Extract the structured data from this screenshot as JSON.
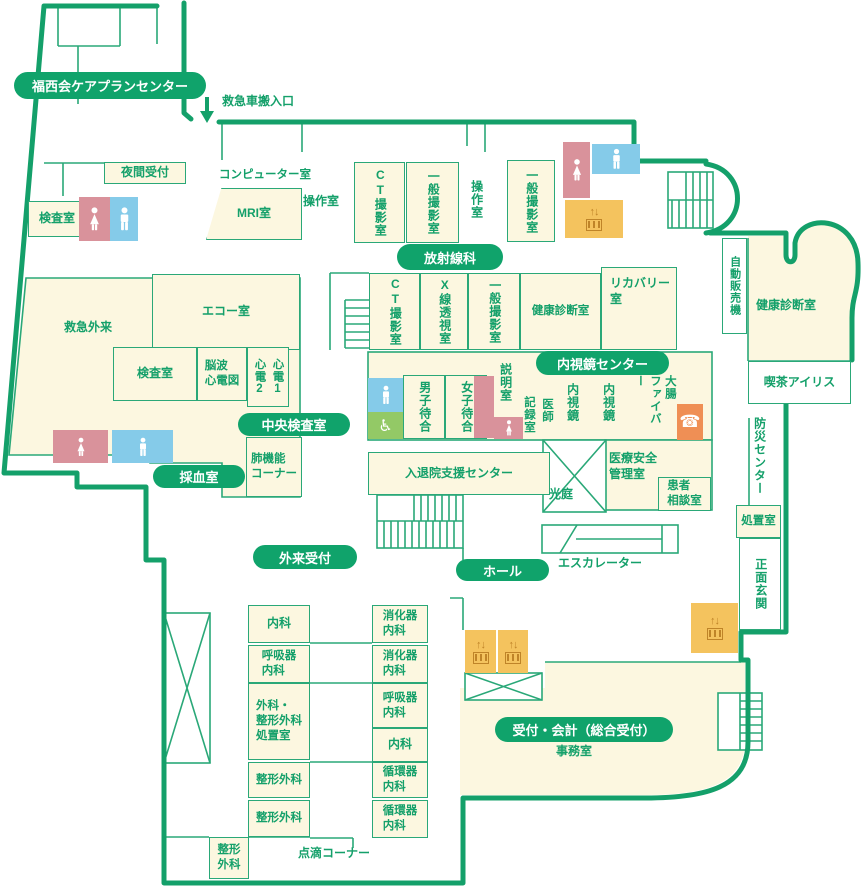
{
  "title": "hospital-floor-map",
  "colors": {
    "outline_green": "#14a06a",
    "line_green": "#2aa878",
    "pill_green": "#10a36b",
    "room_cream": "#fcf7e0",
    "female_pink": "#d9929b",
    "male_blue": "#85cbe9",
    "accessible_green": "#93c966",
    "elevator_orange": "#f4c35e",
    "phone_orange": "#ef8f55"
  },
  "pills": {
    "care_center": "福西会ケアプランセンター",
    "radiology": "放射線科",
    "endoscopy_center": "内視鏡センター",
    "central_lab": "中央検査室",
    "blood_draw": "採血室",
    "outpatient_reception": "外来受付",
    "hall": "ホール",
    "reception_accounting": "受付・会計（総合受付）"
  },
  "rooms": {
    "ambulance_entrance": "救急車搬入口",
    "night_reception": "夜間受付",
    "exam_room_nw": "検査室",
    "computer_room": "コンピューター室",
    "mri": "MRI室",
    "operation_room_1": "操作室",
    "ct_room_1": "CT撮影室",
    "general_xray_1": "一般撮影室",
    "operation_room_2": "操作室",
    "general_xray_2": "一般撮影室",
    "ct_room_2": "CT撮影室",
    "xray_fluoroscopy": "X線透視室",
    "general_xray_3": "一般撮影室",
    "health_checkup_1": "健康診断室",
    "recovery": "リカバリー\n室",
    "vending": "自動販売機",
    "health_checkup_2": "健康診断室",
    "cafe": "喫茶アイリス",
    "disaster_center": "防災センター",
    "treatment": "処置室",
    "main_entrance": "正面玄関",
    "emergency_outpatient": "救急外来",
    "echo": "エコー室",
    "exam_room_w": "検査室",
    "eeg_ecg": "脳波\n心電図",
    "ecg2": "心電2",
    "ecg1": "心電1",
    "lung_corner": "肺機能\nコーナー",
    "mens_waiting": "男子待合",
    "womens_waiting": "女子待合",
    "explanation": "説明室",
    "records": "記録室",
    "doctor": "医師",
    "endoscope_1": "内視鏡",
    "endoscope_2": "内視鏡",
    "colon_fiber": "大腸\nファイバー",
    "admission_support": "入退院支援センター",
    "light_court": "光庭",
    "medical_safety": "医療安全\n管理室",
    "patient_consult": "患者\n相談室",
    "escalator": "エスカレーター",
    "internal_1": "内科",
    "respiratory_1": "呼吸器\n内科",
    "surgery_ortho": "外科・\n整形外科\n処置室",
    "ortho_1": "整形外科",
    "ortho_2": "整形外科",
    "ortho_3": "整形\n外科",
    "gastro_1": "消化器\n内科",
    "gastro_2": "消化器\n内科",
    "respiratory_2": "呼吸器\n内科",
    "internal_2": "内科",
    "cardio_1": "循環器\n内科",
    "cardio_2": "循環器\n内科",
    "iv_corner": "点滴コーナー",
    "office": "事務室"
  },
  "icons": {
    "wheelchair": "♿",
    "phone": "☎",
    "elevator": "↑↓"
  }
}
